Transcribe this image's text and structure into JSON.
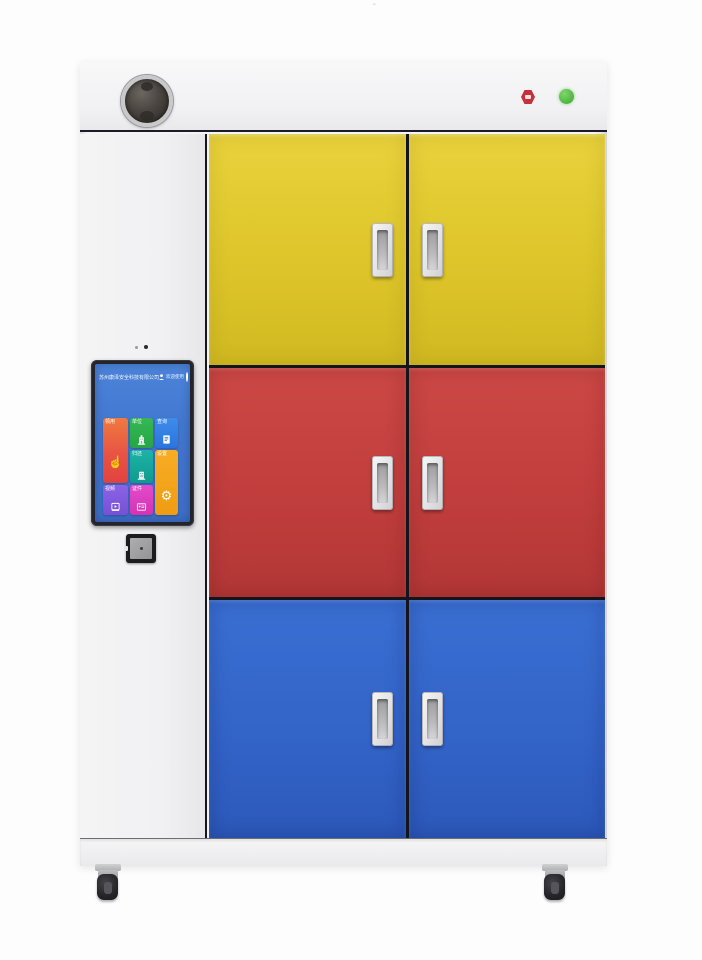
{
  "device": {
    "top_panel": {
      "camera_speaker": "camera-speaker-puck",
      "emergency_button": "emergency-stop-button",
      "status_light_color": "#54bb45",
      "emergency_red": "#c4313b"
    },
    "doors": {
      "columns": 2,
      "rows": [
        {
          "color_name": "yellow",
          "hex": "#ddc52a"
        },
        {
          "color_name": "red",
          "hex": "#c13e3d"
        },
        {
          "color_name": "blue",
          "hex": "#3364c8"
        }
      ],
      "handle_count": 6
    },
    "wheels": 2
  },
  "screen": {
    "background": "#4377cf",
    "header": {
      "company_name": "苏州康泽安全科技有限公司",
      "user_label": "欢迎使用",
      "user_icon": "user-icon",
      "power_icon": "power-icon"
    },
    "tiles": [
      {
        "label": "领用",
        "icon": "tap-hand-icon",
        "color": "#e85444"
      },
      {
        "label": "单位",
        "icon": "building-icon",
        "color": "#2cb04c"
      },
      {
        "label": "查询",
        "icon": "record-list-icon",
        "color": "#2f80e4"
      },
      {
        "label": "归还",
        "icon": "building-return-icon",
        "color": "#14ada0"
      },
      {
        "label": "设置",
        "icon": "gears-icon",
        "color": "#f4a41d"
      },
      {
        "label": "视频",
        "icon": "video-icon",
        "color": "#7e57e0"
      },
      {
        "label": "证件",
        "icon": "id-card-icon",
        "color": "#de3fc4"
      }
    ],
    "tile_icon_glyphs": {
      "tap_hand": "☝",
      "gear": "⚙"
    }
  },
  "reader": {
    "type_hint": "card-reader-module"
  },
  "colors": {
    "cabinet_white": "#f4f4f5",
    "frame_dark": "#14141c",
    "handle_silver": "#e3e3e5"
  }
}
